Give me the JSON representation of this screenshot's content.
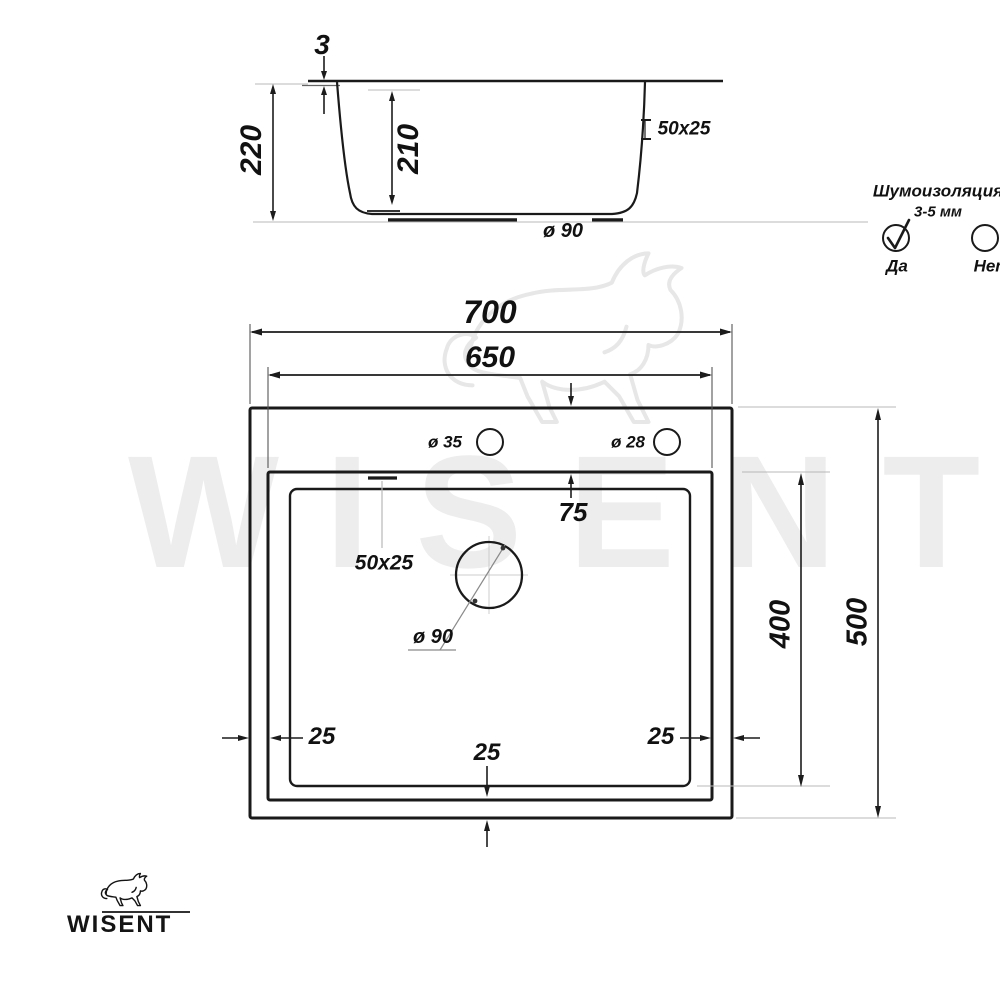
{
  "side_view": {
    "dim_rim_height": "3",
    "dim_total_depth": "220",
    "dim_bowl_depth": "210",
    "dim_overflow": "50x25",
    "dim_drain": "ø 90"
  },
  "noise_insulation": {
    "title": "Шумоизоляция",
    "subtitle": "3-5 мм",
    "yes_label": "Да",
    "no_label": "Нет"
  },
  "top_view": {
    "dim_overall_width": "700",
    "dim_bowl_width": "650",
    "dim_top_offset": "75",
    "hole_faucet": "ø 35",
    "hole_dispenser": "ø 28",
    "overflow": "50x25",
    "drain": "ø 90",
    "dim_bowl_length": "400",
    "dim_overall_length": "500",
    "dim_side_left": "25",
    "dim_side_right": "25",
    "dim_side_bottom": "25"
  },
  "branding": {
    "logo_text": "WISENT",
    "watermark_text": "WISENT"
  },
  "colors": {
    "line": "#1a1a1a",
    "dimension": "#1c1c1c",
    "extension": "#b8b8b8",
    "watermark": "#ededed"
  }
}
